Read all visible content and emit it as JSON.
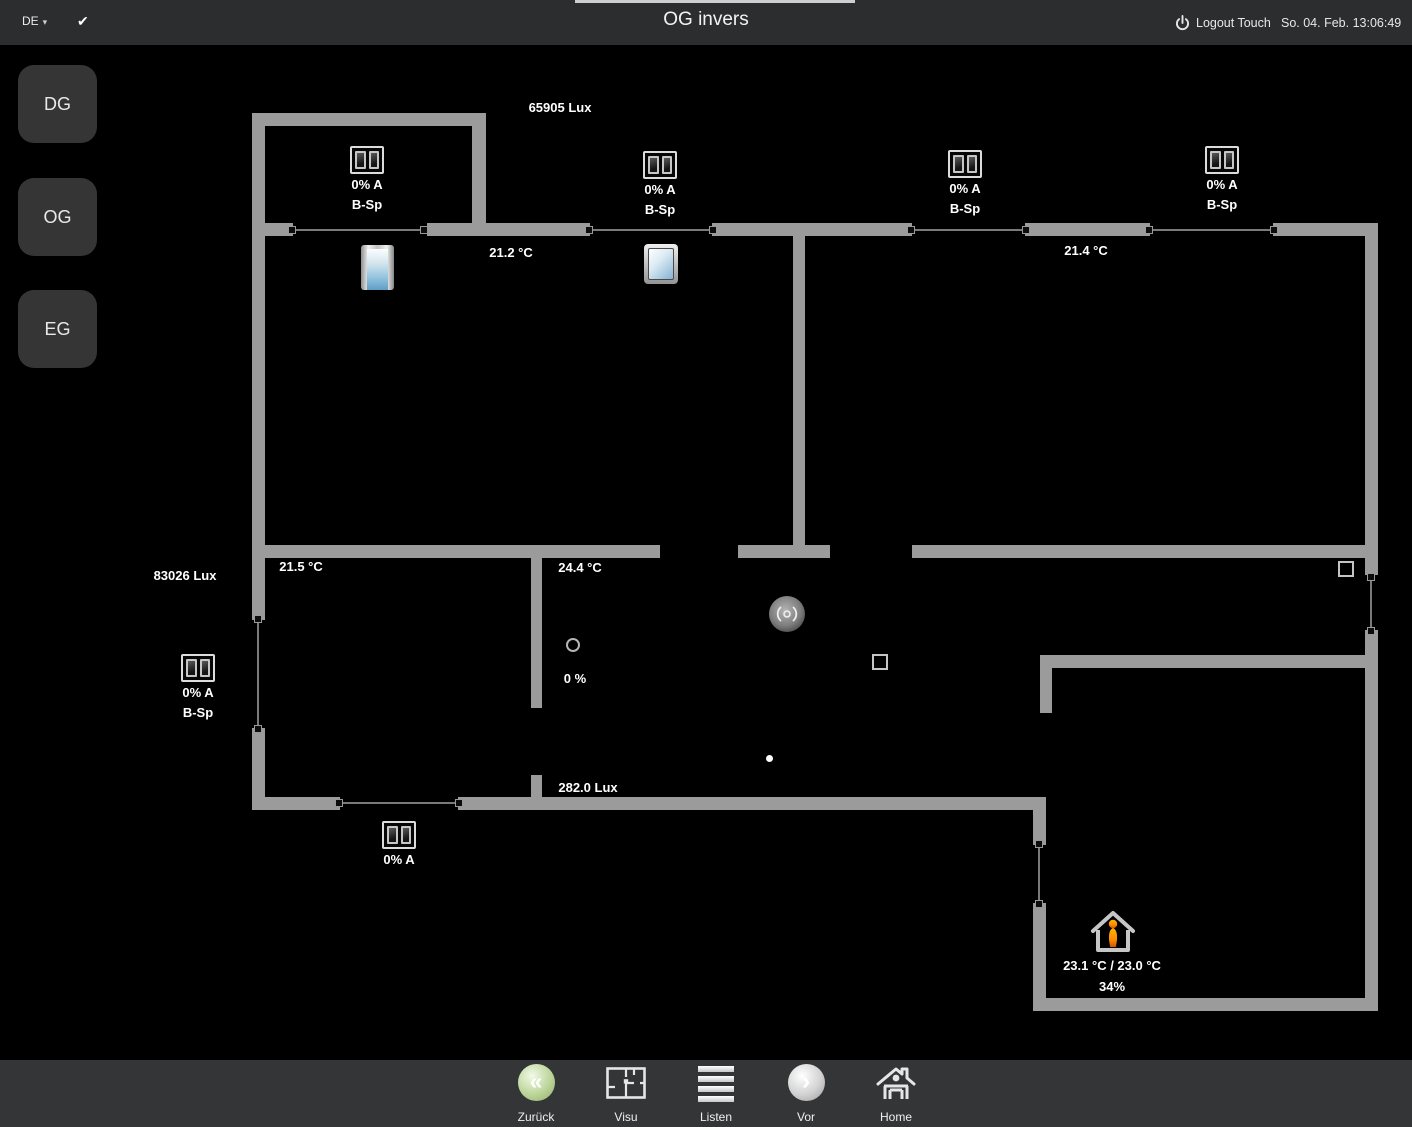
{
  "topbar": {
    "language": "DE",
    "caret": "▾",
    "check": "✔",
    "title": "OG invers",
    "logout": "Logout Touch",
    "datetime": "So. 04. Feb. 13:06:49"
  },
  "sidebar": {
    "floors": [
      {
        "label": "DG"
      },
      {
        "label": "OG"
      },
      {
        "label": "EG"
      }
    ]
  },
  "plan": {
    "lux_top": "65905 Lux",
    "lux_left": "83026 Lux",
    "lux_bottom": "282.0 Lux",
    "temp_top_center": "21.2 °C",
    "temp_top_right": "21.4 °C",
    "temp_mid_left": "21.5 °C",
    "temp_mid_center": "24.4 °C",
    "blinds": [
      {
        "value": "0% A",
        "mode": "B-Sp"
      },
      {
        "value": "0% A",
        "mode": "B-Sp"
      },
      {
        "value": "0% A",
        "mode": "B-Sp"
      },
      {
        "value": "0% A",
        "mode": "B-Sp"
      },
      {
        "value": "0% A",
        "mode": "B-Sp"
      },
      {
        "value": "0% A"
      }
    ],
    "valve_value": "0 %",
    "climate": {
      "setpoint_line": "23.1 °C / 23.0 °C",
      "humidity": "34%"
    }
  },
  "toolbar": {
    "items": [
      {
        "label": "Zurück"
      },
      {
        "label": "Visu"
      },
      {
        "label": "Listen"
      },
      {
        "label": "Vor"
      },
      {
        "label": "Home"
      }
    ]
  },
  "colors": {
    "wall": "#9b9b9b",
    "bar_bg": "#2b2d2e",
    "accent_back": "#a6c77f",
    "person_orange": "#ff8c00"
  }
}
